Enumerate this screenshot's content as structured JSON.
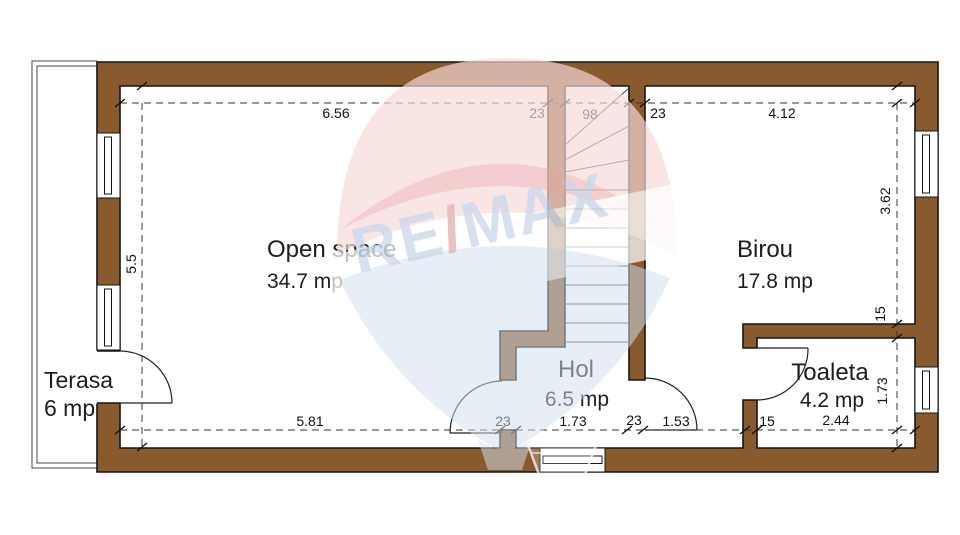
{
  "colors": {
    "wall": "#8a5a2f",
    "outline": "#141414",
    "dim_text": "#111111",
    "watermark_pink": "#f8dada",
    "watermark_pink_dark": "#eeb5b5",
    "watermark_text_blue": "#c3d2e8",
    "watermark_red": "#e2a6a7",
    "watermark_blue": "#d4deed"
  },
  "rooms": {
    "open_space": {
      "name": "Open space",
      "area": "34.7 mp"
    },
    "birou": {
      "name": "Birou",
      "area": "17.8 mp"
    },
    "hol": {
      "name": "Hol",
      "area": "6.5 mp"
    },
    "toaleta": {
      "name": "Toaleta",
      "area": "4.2 mp"
    },
    "terasa": {
      "name": "Terasa",
      "area": "6 mp"
    }
  },
  "dimensions": {
    "top": {
      "open_space_width": "6.56",
      "wall_left": "23",
      "stairs_width": "98",
      "wall_right": "23",
      "birou_width": "4.12"
    },
    "bottom": {
      "open_space_width": "5.81",
      "post_left": "23",
      "hol_width": "1.73",
      "post_right": "23",
      "passage_width": "1.53",
      "toaleta_wall": "15",
      "toaleta_width": "2.44"
    },
    "left": {
      "open_space_height": "5.5"
    },
    "right": {
      "birou_height": "3.62",
      "wall": "15",
      "toaleta_height": "1.73"
    }
  },
  "watermark": {
    "re": "RE",
    "slash": "/",
    "max": "MAX"
  }
}
